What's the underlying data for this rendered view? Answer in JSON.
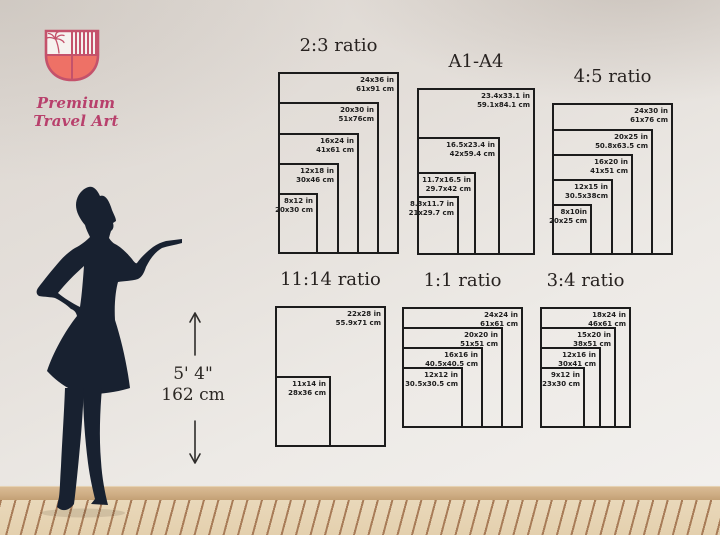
{
  "brand": {
    "name": "Premium Travel Art",
    "logo_icon": "shield-palm-crest-icon"
  },
  "height_reference": {
    "figure_icon": "woman-silhouette",
    "arrow_icons": [
      "arrow-up-icon",
      "arrow-down-icon"
    ],
    "imperial": "5' 4\"",
    "metric": "162 cm"
  },
  "chart_data": {
    "type": "size-guide-diagram",
    "px_per_inch": 5.05,
    "charts": [
      {
        "id": "ratio-2-3",
        "title": "2:3 ratio",
        "layout": {
          "left": 278,
          "top": 33
        },
        "sizes": [
          {
            "inches": "24x36 in",
            "cm": "61x91 cm",
            "w": 24,
            "h": 36
          },
          {
            "inches": "20x30 in",
            "cm": "51x76cm",
            "w": 20,
            "h": 30
          },
          {
            "inches": "16x24 in",
            "cm": "41x61 cm",
            "w": 16,
            "h": 24
          },
          {
            "inches": "12x18 in",
            "cm": "30x46 cm",
            "w": 12,
            "h": 18
          },
          {
            "inches": "8x12 in",
            "cm": "20x30 cm",
            "w": 8,
            "h": 12
          }
        ]
      },
      {
        "id": "a1-a4",
        "title": "A1-A4",
        "layout": {
          "left": 417,
          "top": 49
        },
        "sizes": [
          {
            "inches": "23.4x33.1 in",
            "cm": "59.1x84.1 cm",
            "w": 23.4,
            "h": 33.1
          },
          {
            "inches": "16.5x23.4 in",
            "cm": "42x59.4 cm",
            "w": 16.5,
            "h": 23.4
          },
          {
            "inches": "11.7x16.5 in",
            "cm": "29.7x42 cm",
            "w": 11.7,
            "h": 16.5
          },
          {
            "inches": "8.3x11.7 in",
            "cm": "21x29.7 cm",
            "w": 8.3,
            "h": 11.7
          }
        ]
      },
      {
        "id": "ratio-4-5",
        "title": "4:5 ratio",
        "layout": {
          "left": 552,
          "top": 64
        },
        "sizes": [
          {
            "inches": "24x30 in",
            "cm": "61x76 cm",
            "w": 24,
            "h": 30
          },
          {
            "inches": "20x25 in",
            "cm": "50.8x63.5 cm",
            "w": 20,
            "h": 25
          },
          {
            "inches": "16x20 in",
            "cm": "41x51 cm",
            "w": 16,
            "h": 20
          },
          {
            "inches": "12x15 in",
            "cm": "30.5x38cm",
            "w": 12,
            "h": 15
          },
          {
            "inches": "8x10in",
            "cm": "20x25 cm",
            "w": 8,
            "h": 10
          }
        ]
      },
      {
        "id": "ratio-11-14",
        "title": "11:14 ratio",
        "layout": {
          "left": 275,
          "top": 267
        },
        "sizes": [
          {
            "inches": "22x28 in",
            "cm": "55.9x71 cm",
            "w": 22,
            "h": 28
          },
          {
            "inches": "11x14 in",
            "cm": "28x36 cm",
            "w": 11,
            "h": 14
          }
        ]
      },
      {
        "id": "ratio-1-1",
        "title": "1:1 ratio",
        "layout": {
          "left": 402,
          "top": 268
        },
        "sizes": [
          {
            "inches": "24x24 in",
            "cm": "61x61 cm",
            "w": 24,
            "h": 24
          },
          {
            "inches": "20x20 in",
            "cm": "51x51 cm",
            "w": 20,
            "h": 20
          },
          {
            "inches": "16x16 in",
            "cm": "40.5x40.5 cm",
            "w": 16,
            "h": 16
          },
          {
            "inches": "12x12 in",
            "cm": "30.5x30.5 cm",
            "w": 12,
            "h": 12
          }
        ]
      },
      {
        "id": "ratio-3-4",
        "title": "3:4 ratio",
        "layout": {
          "left": 540,
          "top": 268
        },
        "sizes": [
          {
            "inches": "18x24 in",
            "cm": "46x61 cm",
            "w": 18,
            "h": 24
          },
          {
            "inches": "15x20 in",
            "cm": "38x51 cm",
            "w": 15,
            "h": 20
          },
          {
            "inches": "12x16 in",
            "cm": "30x41 cm",
            "w": 12,
            "h": 16
          },
          {
            "inches": "9x12 in",
            "cm": "23x30 cm",
            "w": 9,
            "h": 12
          }
        ]
      }
    ]
  },
  "colors": {
    "ink": "#1c1c1c",
    "wall": "#e6e1dc",
    "baseboard": "#cfae85",
    "floor": "#e6d3b4",
    "floor_line": "#a87c58",
    "silhouette": "#182130",
    "logo_crimson": "#c44f66",
    "logo_coral": "#ee7166",
    "brand_pink": "#b8406c"
  }
}
